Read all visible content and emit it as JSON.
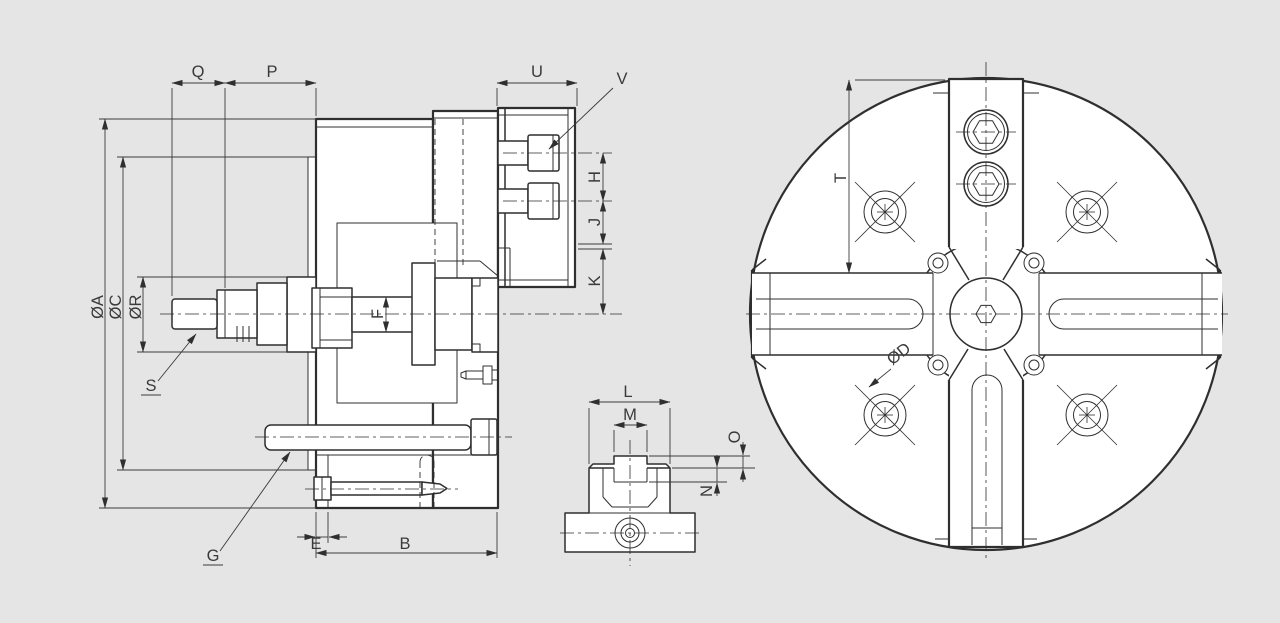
{
  "drawing": {
    "background_color": "#e5e5e5",
    "paper_color": "#ffffff",
    "line_color": "#2f2f2f",
    "text_color": "#3a3a3a",
    "labels": {
      "q": "Q",
      "p": "P",
      "u": "U",
      "v": "V",
      "h": "H",
      "j": "J",
      "k": "K",
      "phi_a": "ØA",
      "phi_c": "ØC",
      "phi_r": "ØR",
      "f": "F",
      "s": "S",
      "g": "G",
      "e": "E",
      "b": "B",
      "l": "L",
      "m": "M",
      "o": "O",
      "n": "N",
      "t": "T",
      "phi_d": "ØD"
    }
  }
}
